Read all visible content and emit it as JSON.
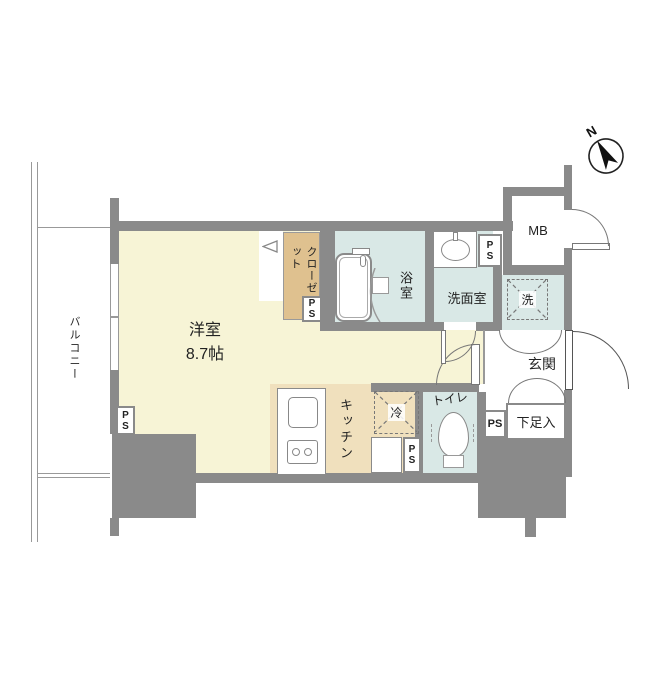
{
  "compass": {
    "north_label": "N"
  },
  "rooms": {
    "balcony": {
      "label": "バルコニー"
    },
    "living": {
      "label": "洋室",
      "size": "8.7帖"
    },
    "closet": {
      "label": "クローゼット"
    },
    "bath": {
      "label": "浴室"
    },
    "washroom": {
      "label": "洗面室"
    },
    "laundry": {
      "label": "洗"
    },
    "meter_box": {
      "label": "MB"
    },
    "entrance": {
      "label": "玄関"
    },
    "shoe_cabinet": {
      "label": "下足入"
    },
    "toilet": {
      "label": "トイレ"
    },
    "kitchen": {
      "label": "キッチン"
    },
    "refrigerator": {
      "label": "冷"
    }
  },
  "pipe_space": {
    "label": "PS"
  },
  "colors": {
    "wall": "#8a8a8a",
    "living_floor": "#f7f4d6",
    "kitchen_floor": "#f0e0bd",
    "closet_floor": "#dfc18f",
    "wet_area_floor": "#d9e8e6",
    "door_line": "#777777"
  }
}
